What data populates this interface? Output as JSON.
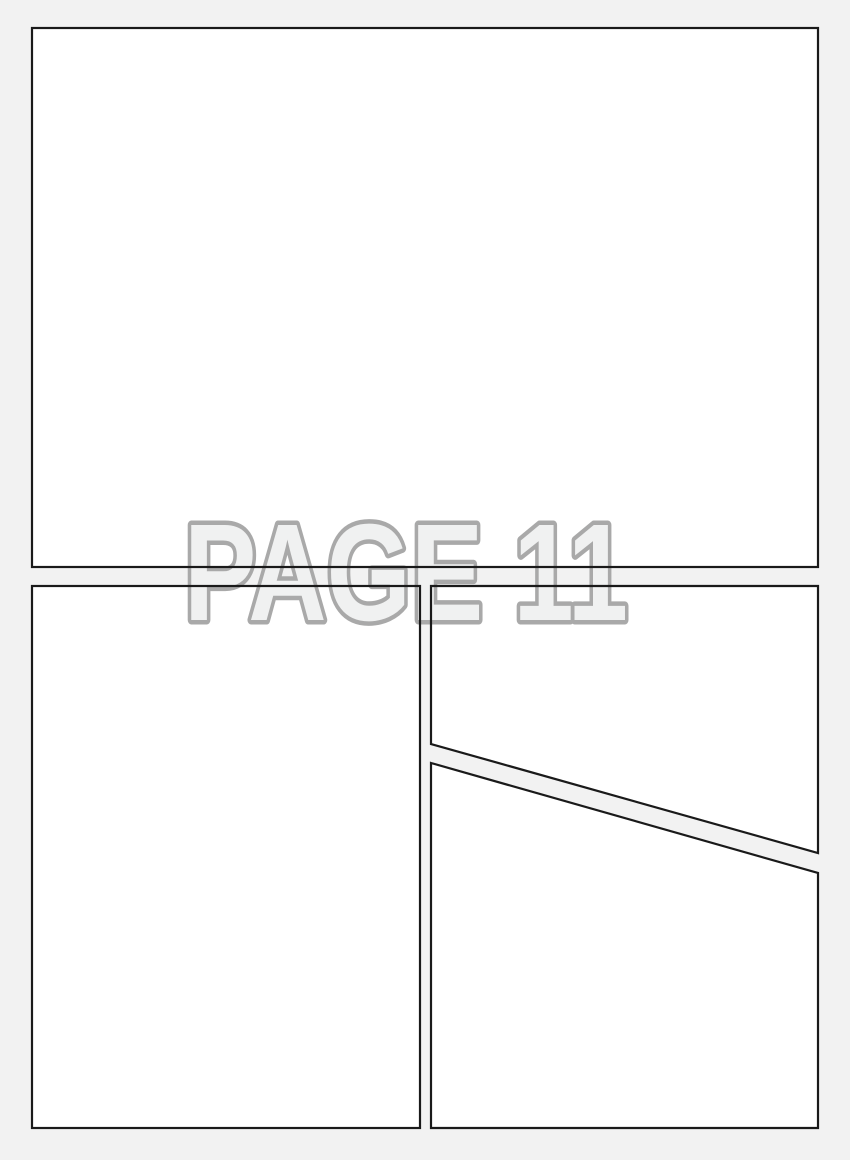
{
  "page": {
    "label": "PAGE 11"
  },
  "colors": {
    "background": "#f2f2f2",
    "panel_fill": "#ffffff",
    "panel_border": "#1a1a1a",
    "label_fill": "#f0f1f1",
    "label_outline": "#a9a9a9"
  },
  "panels": [
    {
      "name": "top-panel"
    },
    {
      "name": "bottom-left-panel"
    },
    {
      "name": "bottom-right-upper-panel"
    },
    {
      "name": "bottom-right-lower-panel"
    }
  ]
}
